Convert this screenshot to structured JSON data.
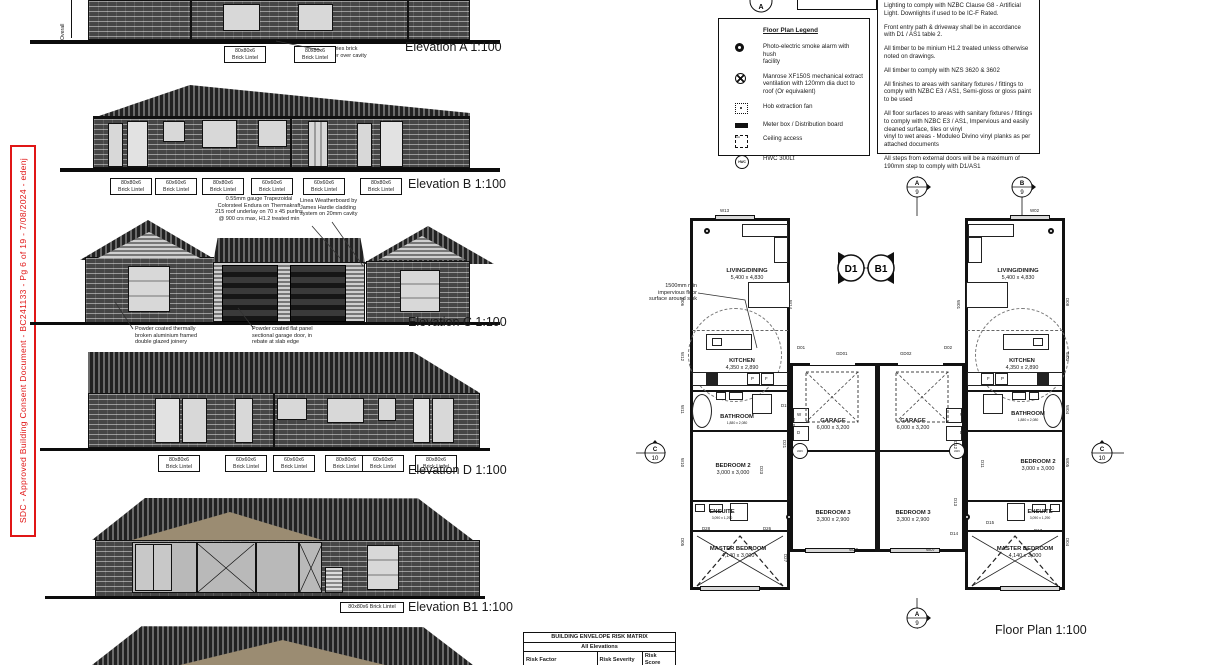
{
  "stamp": {
    "text": "SDC - Approved Building Consent Document - BC241133 - Pg 6 of 19 - 7/08/2024 - edenj"
  },
  "elevations": {
    "overall_label": "Overall",
    "a": {
      "title": "Elevation A  1:100",
      "veneer_note": "70 series brick\nveneer over cavity",
      "lintels": [
        "80x80x6\nBrick Lintel",
        "80x80x6\nBrick Lintel"
      ]
    },
    "b": {
      "title": "Elevation B  1:100",
      "lintels": [
        "80x80x6\nBrick Lintel",
        "60x60x6\nBrick Lintel",
        "80x80x6\nBrick Lintel",
        "60x60x6\nBrick Lintel",
        "60x60x6\nBrick Lintel",
        "80x80x6\nBrick Lintel"
      ]
    },
    "c": {
      "title": "Elevation C  1:100",
      "roof_note": "0.55mm gauge Trapezoidal\nColorsteel Endura on Thermakraft\n215 roof underlay on 70 x 45 purlins\n@ 900 crs max, H1.2 treated min",
      "cladding_note": "Linea Weatherboard by\nJames Hardie cladding\nsystem on 20mm cavity",
      "joinery_note": "Powder coated thermally\nbroken aluminium framed\ndouble glazed joinery",
      "garage_note": "Powder coated flat panel\nsectional garage door, in\nrebate at slab edge"
    },
    "d": {
      "title": "Elevation D  1:100",
      "lintels": [
        "80x80x6\nBrick Lintel",
        "60x60x6\nBrick Lintel",
        "60x60x6\nBrick Lintel",
        "80x80x6\nBrick Lintel",
        "60x60x6\nBrick Lintel",
        "80x80x6\nBrick Lintel"
      ]
    },
    "b1": {
      "title": "Elevation B1   1:100",
      "lintel": "80x80x6 Brick Lintel"
    }
  },
  "legend": {
    "title": "Floor Plan Legend",
    "hwc_icon_text": "HWC",
    "items": [
      {
        "icon": "smoke-alarm",
        "label": "Photo-electric smoke alarm with hush\nfacility"
      },
      {
        "icon": "extract-fan",
        "label": "Manrose XF150S mechanical extract\nventilation with 120mm dia duct to\nroof (Or equivalent)"
      },
      {
        "icon": "hob-fan",
        "label": "Hob extraction fan"
      },
      {
        "icon": "meter-box",
        "label": "Meter box / Distribution board"
      },
      {
        "icon": "ceiling-access",
        "label": "Ceiling access"
      },
      {
        "icon": "hwc",
        "label": "HWC 300Lt"
      }
    ]
  },
  "notes": {
    "paragraphs": [
      "Lighting to comply with NZBC Clause G8 - Artificial Light. Downlights if used to be IC-F Rated.",
      "Front entry path & driveway shall be in accordance with D1 / AS1 table 2.",
      "All timber to be minium H1.2 treated unless otherwise noted on drawings.",
      "All timber to comply with NZS 3620 & 3602",
      "All finishes to areas with sanitary fixtures / fittings to comply with NZBC E3 / AS1, Semi-gloss or gloss paint to be used",
      "All floor surfaces to areas with sanitary fixtures / fittings to comply with NZBC E3 / AS1, Impervious and easily cleaned surface, tiles or vinyl\nvinyl to wet areas - Moduleo Divino vinyl planks as per attached documents",
      "All steps from external doors will be a maximum of 190mm step to comply with D1/AS1"
    ]
  },
  "risk_matrix": {
    "title": "BUILDING ENVELOPE RISK MATRIX",
    "subtitle": "All Elevations",
    "headers": [
      "Risk Factor",
      "Risk Severity",
      "Risk Score"
    ],
    "rows": [
      [
        "Wind zone (per NZS 3604)",
        "Medium risk",
        "0"
      ]
    ]
  },
  "floor_plan": {
    "title": "Floor Plan   1:100",
    "sink_note": "1500mm min\nimpervious floor\nsurface around sink",
    "hwc_label": "HWC",
    "rooms_left": [
      {
        "name": "LIVING/DINING",
        "dim": "5,400 x 4,830"
      },
      {
        "name": "KITCHEN",
        "dim": "4,350 x 2,890"
      },
      {
        "name": "BATHROOM",
        "dim": "1,880 x 2,080"
      },
      {
        "name": "BEDROOM 2",
        "dim": "3,000 x 3,000"
      },
      {
        "name": "ENSUITE",
        "dim": "3,090 x 1,290"
      },
      {
        "name": "MASTER BEDROOM",
        "dim": "4,140 x 3,000"
      },
      {
        "name": "GARAGE",
        "dim": "6,000 x 3,200"
      },
      {
        "name": "BEDROOM 3",
        "dim": "3,300 x 2,900"
      }
    ],
    "rooms_right": [
      {
        "name": "LIVING/DINING",
        "dim": "5,400 x 4,830"
      },
      {
        "name": "KITCHEN",
        "dim": "4,350 x 2,890"
      },
      {
        "name": "BATHROOM",
        "dim": "1,880 x 2,080"
      },
      {
        "name": "BEDROOM 2",
        "dim": "3,000 x 3,000"
      },
      {
        "name": "ENSUITE",
        "dim": "3,090 x 1,290"
      },
      {
        "name": "MASTER BEDROOM",
        "dim": "4,140 x 3,000"
      },
      {
        "name": "GARAGE",
        "dim": "6,000 x 3,200"
      },
      {
        "name": "BEDROOM 3",
        "dim": "3,300 x 2,900"
      }
    ],
    "detail_markers": {
      "left": "D1",
      "right": "B1"
    },
    "section_markers": {
      "top_cut": {
        "label": "A"
      },
      "top_left": {
        "label": "A",
        "sheet": "9"
      },
      "top_right": {
        "label": "B",
        "sheet": "9"
      },
      "bottom": {
        "label": "A",
        "sheet": "9"
      },
      "left": {
        "label": "C",
        "sheet": "10"
      },
      "right": {
        "label": "C",
        "sheet": "10"
      }
    },
    "tags": [
      {
        "t": "W13",
        "x": 720,
        "y": 209,
        "r": 0
      },
      {
        "t": "W02",
        "x": 1030,
        "y": 209,
        "r": 0
      },
      {
        "t": "W14",
        "x": 792,
        "y": 300,
        "r": 90
      },
      {
        "t": "W01",
        "x": 960,
        "y": 300,
        "r": 90
      },
      {
        "t": "D06",
        "x": 684,
        "y": 298,
        "r": 90
      },
      {
        "t": "D08",
        "x": 1069,
        "y": 298,
        "r": 90
      },
      {
        "t": "W12",
        "x": 684,
        "y": 352,
        "r": 90
      },
      {
        "t": "W03",
        "x": 1069,
        "y": 352,
        "r": 90
      },
      {
        "t": "W11",
        "x": 684,
        "y": 405,
        "r": 90
      },
      {
        "t": "W04",
        "x": 1069,
        "y": 405,
        "r": 90
      },
      {
        "t": "W10",
        "x": 684,
        "y": 458,
        "r": 90
      },
      {
        "t": "W05",
        "x": 1069,
        "y": 458,
        "r": 90
      },
      {
        "t": "D05",
        "x": 684,
        "y": 538,
        "r": 90
      },
      {
        "t": "D04",
        "x": 1069,
        "y": 538,
        "r": 90
      },
      {
        "t": "D01",
        "x": 797,
        "y": 346,
        "r": 0
      },
      {
        "t": "D02",
        "x": 944,
        "y": 346,
        "r": 0
      },
      {
        "t": "GD01",
        "x": 836,
        "y": 352,
        "r": 0
      },
      {
        "t": "GD02",
        "x": 900,
        "y": 352,
        "r": 0
      },
      {
        "t": "D18",
        "x": 795,
        "y": 418,
        "r": 90
      },
      {
        "t": "D19",
        "x": 781,
        "y": 404,
        "r": 0
      },
      {
        "t": "D21",
        "x": 786,
        "y": 440,
        "r": 90
      },
      {
        "t": "D23",
        "x": 763,
        "y": 466,
        "r": 90
      },
      {
        "t": "D24",
        "x": 790,
        "y": 496,
        "r": 90
      },
      {
        "t": "D26",
        "x": 763,
        "y": 527,
        "r": 0
      },
      {
        "t": "D28",
        "x": 702,
        "y": 527,
        "r": 0
      },
      {
        "t": "D27",
        "x": 787,
        "y": 554,
        "r": 90
      },
      {
        "t": "D10",
        "x": 966,
        "y": 422,
        "r": 90
      },
      {
        "t": "D12",
        "x": 957,
        "y": 441,
        "r": 90
      },
      {
        "t": "D11",
        "x": 984,
        "y": 460,
        "r": 90
      },
      {
        "t": "D13",
        "x": 957,
        "y": 498,
        "r": 90
      },
      {
        "t": "D14",
        "x": 950,
        "y": 532,
        "r": 0
      },
      {
        "t": "D15",
        "x": 986,
        "y": 521,
        "r": 0
      },
      {
        "t": "D16",
        "x": 968,
        "y": 554,
        "r": 90
      },
      {
        "t": "D17",
        "x": 1034,
        "y": 529,
        "r": 0
      },
      {
        "t": "W20",
        "x": 849,
        "y": 548,
        "r": 0
      },
      {
        "t": "W07",
        "x": 926,
        "y": 548,
        "r": 0
      },
      {
        "t": "P",
        "x": 751,
        "y": 377,
        "r": 0
      },
      {
        "t": "F",
        "x": 765,
        "y": 377,
        "r": 0
      },
      {
        "t": "F",
        "x": 987,
        "y": 377,
        "r": 0
      },
      {
        "t": "P",
        "x": 1001,
        "y": 377,
        "r": 0
      },
      {
        "t": "W",
        "x": 797,
        "y": 413,
        "r": 0
      },
      {
        "t": "D",
        "x": 797,
        "y": 431,
        "r": 0
      },
      {
        "t": "W",
        "x": 960,
        "y": 413,
        "r": 0
      },
      {
        "t": "D",
        "x": 960,
        "y": 431,
        "r": 0
      }
    ]
  }
}
